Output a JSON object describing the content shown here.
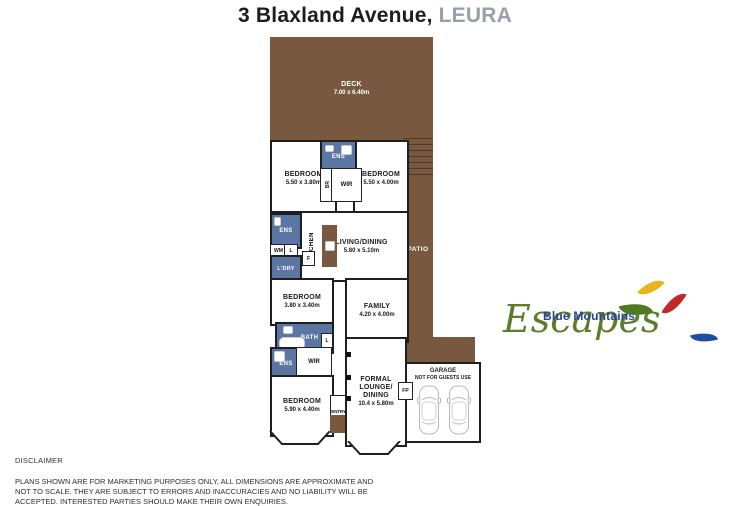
{
  "header": {
    "address": "3 Blaxland Avenue,",
    "suburb": "LEURA"
  },
  "plan": {
    "deck": {
      "label": "DECK",
      "dims": "7.00 x 6.40m"
    },
    "patio_label": "PATIO",
    "garage": {
      "line1": "GARAGE",
      "line2": "NOT FOR GUESTS USE"
    },
    "rooms": {
      "bed_top_left": {
        "label": "BEDROOM",
        "dims": "5.50 x 3.80m"
      },
      "bed_top_right": {
        "label": "BEDROOM",
        "dims": "5.50 x 4.00m"
      },
      "living": {
        "label": "LIVING/DINING",
        "dims": "5.80 x 5.10m"
      },
      "bed_mid": {
        "label": "BEDROOM",
        "dims": "3.80 x 3.40m"
      },
      "family": {
        "label": "FAMILY",
        "dims": "4.20 x 4.00m"
      },
      "bed_bottom": {
        "label": "BEDROOM",
        "dims": "5.90 x 4.40m"
      },
      "formal": {
        "line1": "FORMAL",
        "line2": "LOUNGE/",
        "line3": "DINING",
        "dims": "10.4 x 5.80m"
      }
    },
    "labels": {
      "ens": "ENS",
      "wir": "WIR",
      "br": "BR",
      "bath": "BATH",
      "ldry": "L'DRY",
      "kitchen": "KITCHEN",
      "wm": "WM",
      "l": "L",
      "f": "F",
      "fp": "FP",
      "entry": "ENTRY"
    }
  },
  "logo": {
    "name_top": "Blue Mountains",
    "name_script": "Escapes"
  },
  "disclaimer": {
    "title": "DISCLAIMER",
    "line1": "PLANS SHOWN ARE FOR MARKETING PURPOSES ONLY, ALL DIMENSIONS ARE APPROXIMATE AND",
    "line2": "NOT TO SCALE. THEY ARE SUBJECT TO ERRORS AND INACCURACIES AND NO LIABILITY WILL BE",
    "line3": "ACCEPTED. INTERESTED PARTIES SHOULD MAKE THEIR OWN ENQUIRIES."
  },
  "colors": {
    "deck_brown": "#78593F",
    "wet_area_blue": "#5B76A2",
    "wall": "#1F1F1F",
    "suburb_gray": "#97A0AB",
    "logo_blue": "#27439A",
    "logo_green": "#5C7D2B",
    "leaf_green": "#4E7B1F",
    "leaf_yellow": "#E9B51E",
    "leaf_red": "#C02928",
    "leaf_blue": "#1C4FA0"
  }
}
